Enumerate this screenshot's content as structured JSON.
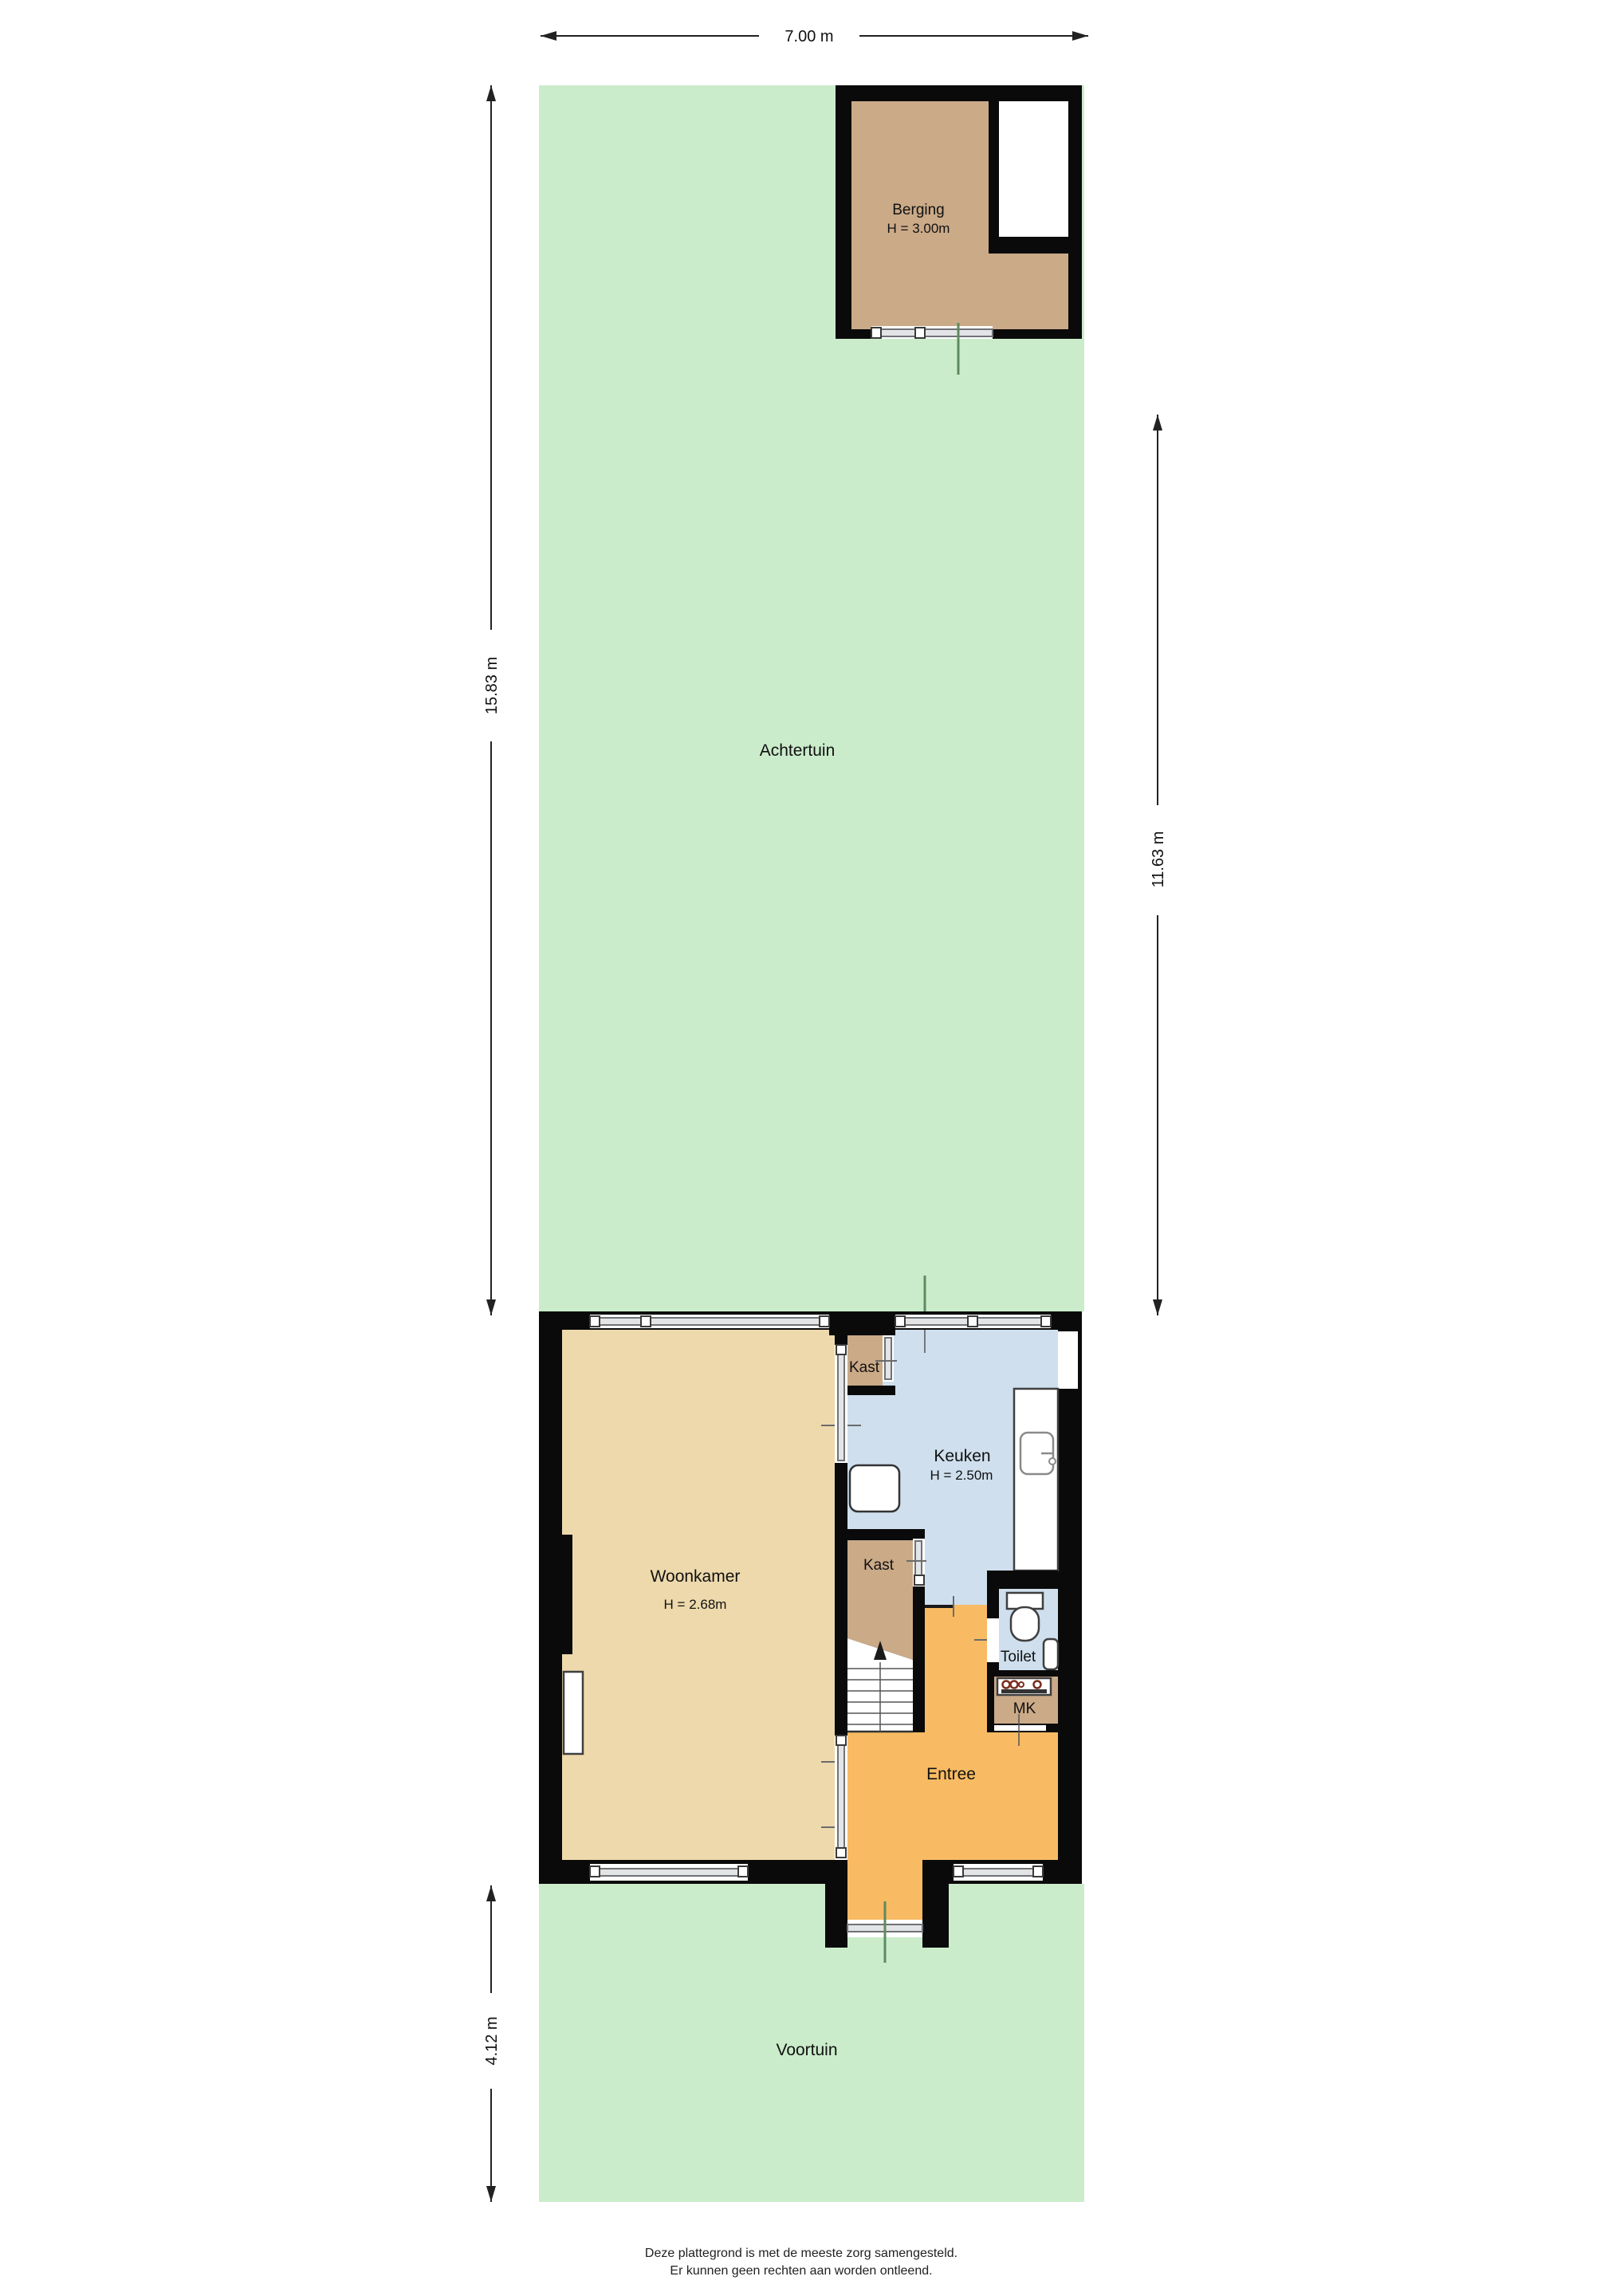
{
  "plan": {
    "dimensions": {
      "top_width": "7.00 m",
      "garden_height": "15.83 m",
      "right_height": "11.63 m",
      "front_garden_height": "4.12 m"
    },
    "areas": {
      "back_garden": "Achtertuin",
      "front_garden": "Voortuin"
    },
    "rooms": {
      "berging": {
        "name": "Berging",
        "height": "H = 3.00m"
      },
      "woonkamer": {
        "name": "Woonkamer",
        "height": "H = 2.68m"
      },
      "keuken": {
        "name": "Keuken",
        "height": "H = 2.50m"
      },
      "kast_top": {
        "name": "Kast"
      },
      "kast_middle": {
        "name": "Kast"
      },
      "toilet": {
        "name": "Toilet"
      },
      "meter_closet": {
        "name": "MK"
      },
      "entree": {
        "name": "Entree"
      }
    },
    "disclaimer": {
      "line1": "Deze plattegrond is met de meeste zorg samengesteld.",
      "line2": "Er kunnen geen rechten aan worden ontleend."
    },
    "colors": {
      "garden_green": "#cbeccb",
      "wall_black": "#0a0a0a",
      "living_beige": "#edd9ac",
      "kitchen_blue": "#cfdfed",
      "hall_orange": "#f8bb63",
      "storage_brown": "#cbaa88",
      "glass_gray": "#e3e4e5",
      "path_green": "#5f8a5f",
      "dimension_dark": "#222222"
    }
  }
}
